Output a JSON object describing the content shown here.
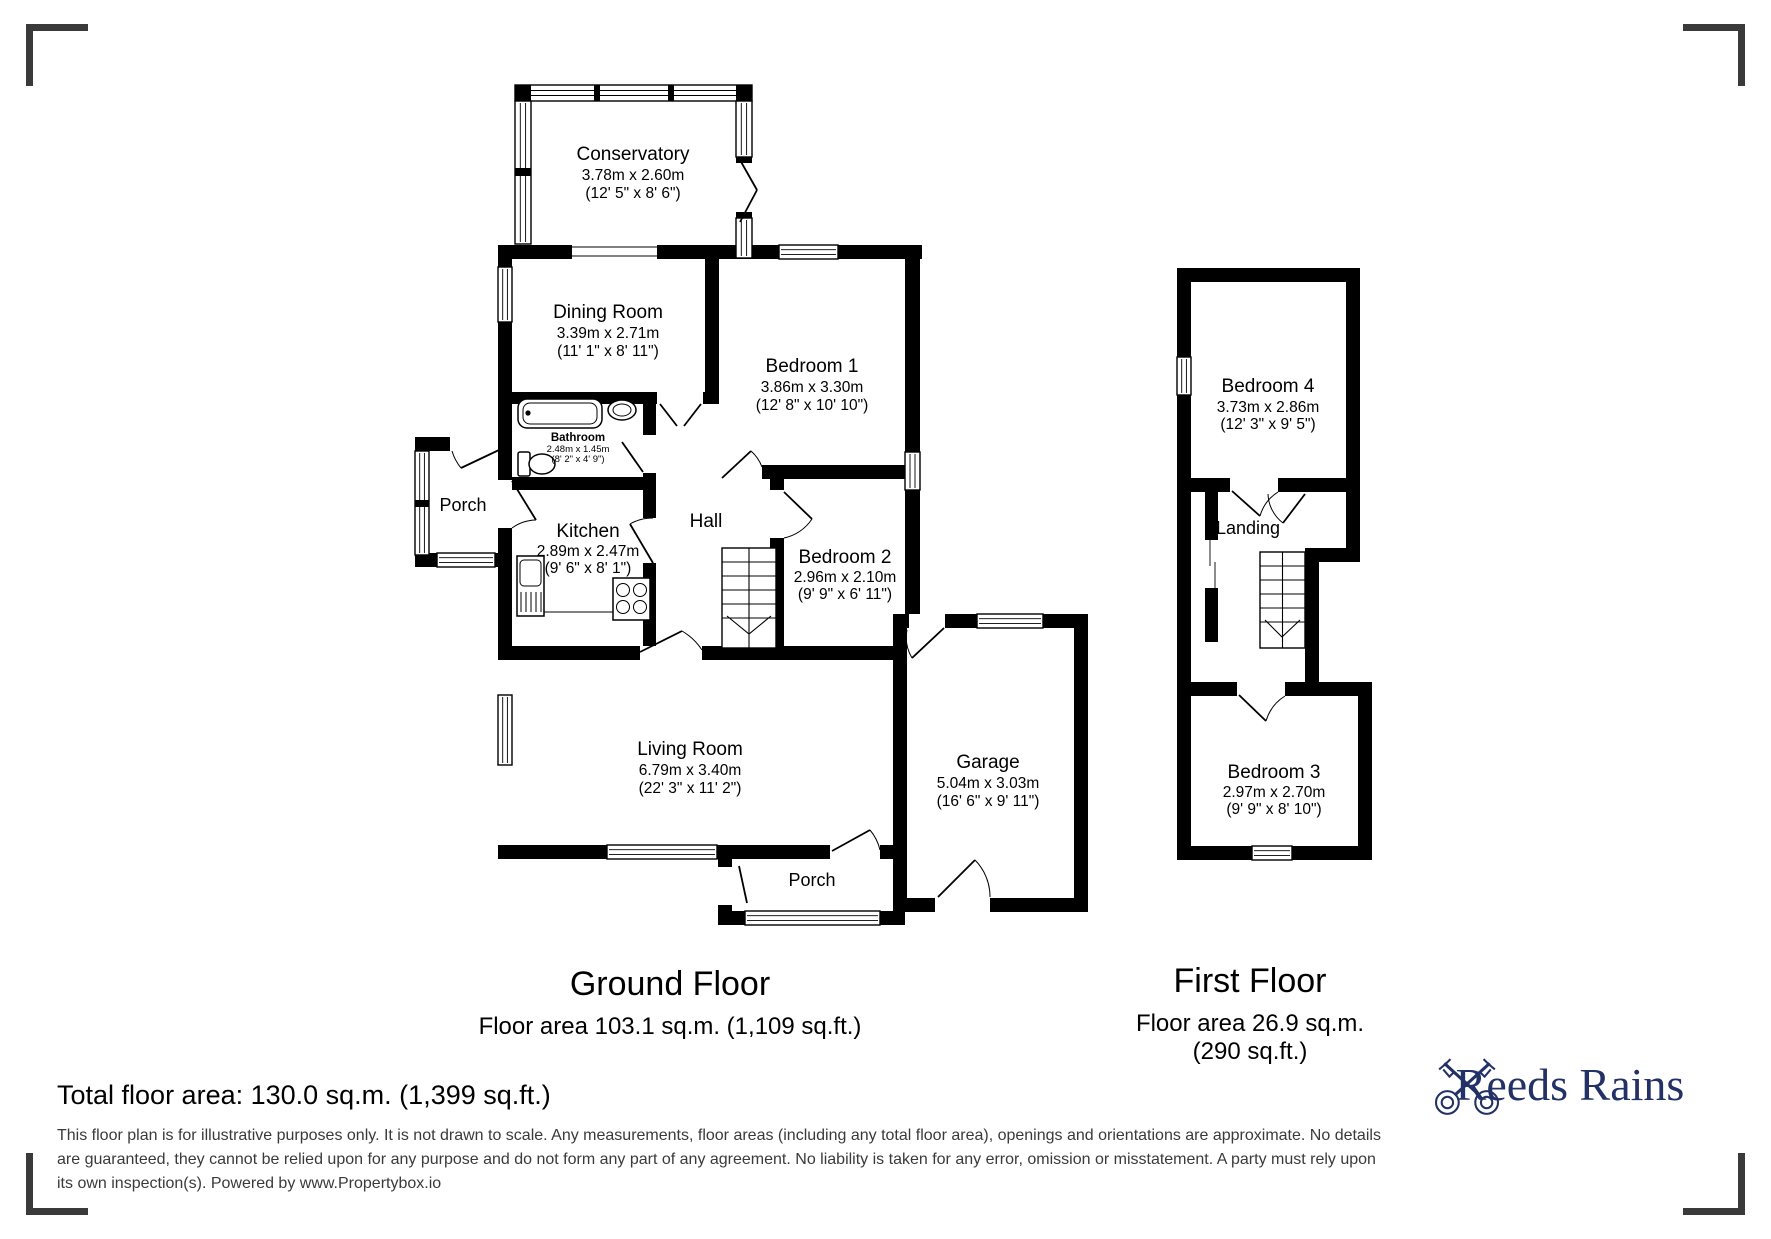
{
  "ground_floor": {
    "title": "Ground Floor",
    "area_label": "Floor area 103.1 sq.m. (1,109 sq.ft.)",
    "rooms": {
      "conservatory": {
        "name": "Conservatory",
        "metric": "3.78m x 2.60m",
        "imperial": "(12' 5\" x 8' 6\")"
      },
      "dining_room": {
        "name": "Dining Room",
        "metric": "3.39m x 2.71m",
        "imperial": "(11' 1\" x 8' 11\")"
      },
      "bedroom_1": {
        "name": "Bedroom 1",
        "metric": "3.86m x 3.30m",
        "imperial": "(12' 8\" x 10' 10\")"
      },
      "bathroom": {
        "name": "Bathroom",
        "metric": "2.48m x 1.45m",
        "imperial": "(8' 2\" x 4' 9\")"
      },
      "porch_front": {
        "name": "Porch"
      },
      "kitchen": {
        "name": "Kitchen",
        "metric": "2.89m x 2.47m",
        "imperial": "(9' 6\" x 8' 1\")"
      },
      "hall": {
        "name": "Hall"
      },
      "bedroom_2": {
        "name": "Bedroom 2",
        "metric": "2.96m x 2.10m",
        "imperial": "(9' 9\" x 6' 11\")"
      },
      "living_room": {
        "name": "Living Room",
        "metric": "6.79m x 3.40m",
        "imperial": "(22' 3\" x 11' 2\")"
      },
      "garage": {
        "name": "Garage",
        "metric": "5.04m x 3.03m",
        "imperial": "(16' 6\" x 9' 11\")"
      },
      "porch_rear": {
        "name": "Porch"
      }
    }
  },
  "first_floor": {
    "title": "First Floor",
    "area_label_line1": "Floor area 26.9 sq.m.",
    "area_label_line2": "(290 sq.ft.)",
    "rooms": {
      "bedroom_4": {
        "name": "Bedroom 4",
        "metric": "3.73m x 2.86m",
        "imperial": "(12' 3\" x 9' 5\")"
      },
      "landing": {
        "name": "Landing"
      },
      "bedroom_3": {
        "name": "Bedroom 3",
        "metric": "2.97m x 2.70m",
        "imperial": "(9' 9\" x 8' 10\")"
      }
    }
  },
  "footer": {
    "total_area": "Total floor area: 130.0 sq.m. (1,399 sq.ft.)",
    "disclaimer": "This floor plan is for illustrative purposes only. It is not drawn to scale. Any measurements, floor areas (including any total floor area), openings and orientations are approximate. No details are guaranteed, they cannot be relied upon for any purpose and do not form any part of any agreement. No liability is taken for any error, omission or misstatement. A party must rely upon its own inspection(s). Powered by www.Propertybox.io"
  },
  "brand": {
    "name": "Reeds Rains",
    "color": "#223166"
  }
}
